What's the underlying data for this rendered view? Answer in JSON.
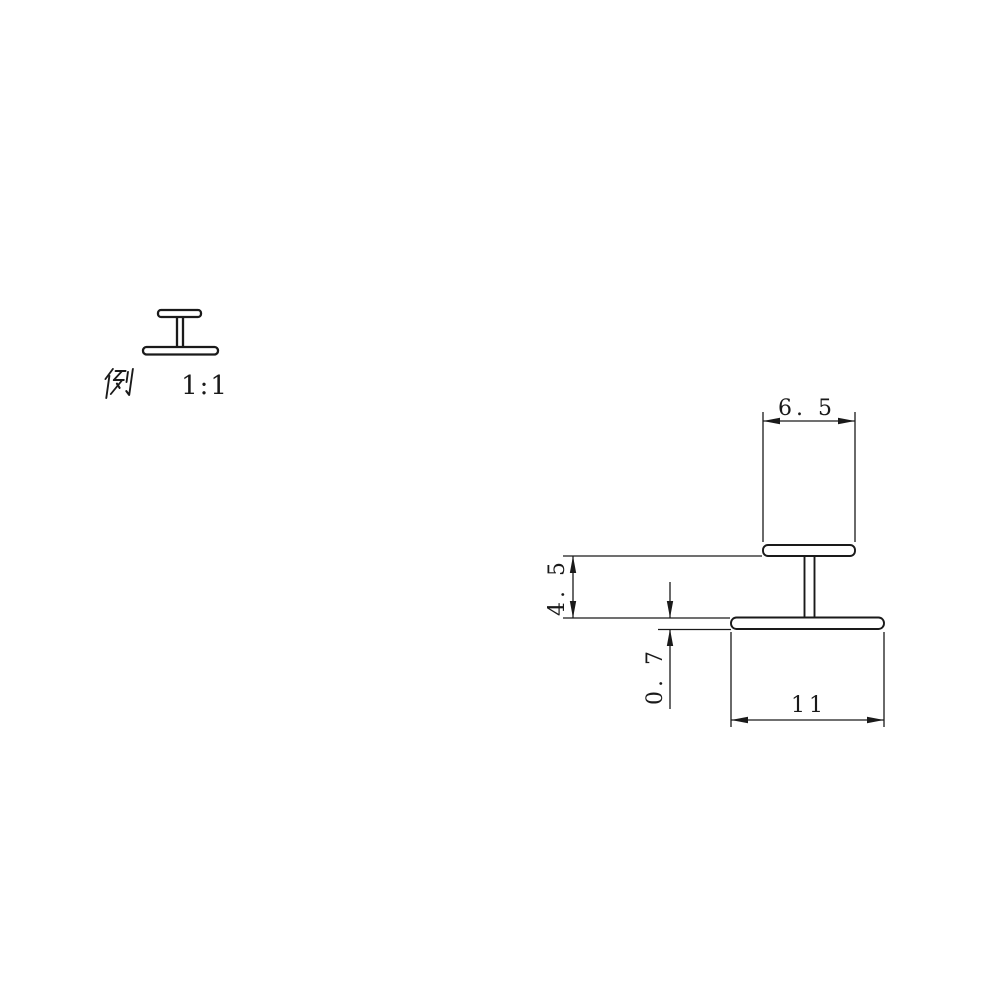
{
  "sheet": {
    "background": "#ffffff",
    "line_color": "#1a1a1a"
  },
  "legend": {
    "label": "例",
    "scale": "1:1"
  },
  "profile": {
    "shape": "H-section extrusion cross-section",
    "dimensions": {
      "top_flange_width": {
        "label": "6. 5",
        "value": 6.5
      },
      "web_height": {
        "label": "4. 5",
        "value": 4.5
      },
      "flange_thickness": {
        "label": "0. 7",
        "value": 0.7
      },
      "bottom_flange_width": {
        "label": "11",
        "value": 11
      }
    }
  }
}
